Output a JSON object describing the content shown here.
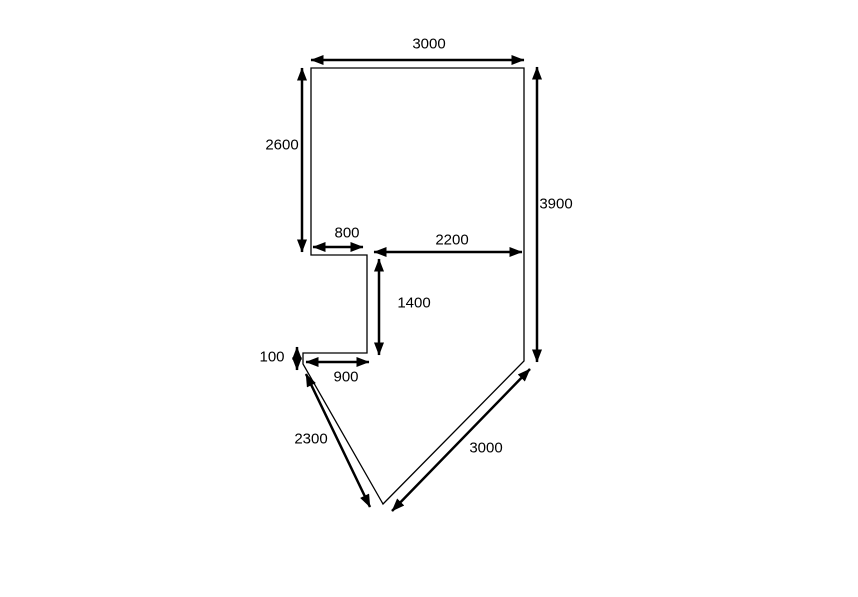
{
  "canvas": {
    "width": 858,
    "height": 597,
    "background": "#ffffff",
    "line_color": "#000000"
  },
  "style": {
    "outline_width": 1.3,
    "dimension_width": 2.5,
    "label_font_size": 15,
    "arrow_length": 13,
    "arrow_half_width": 5
  },
  "shape": {
    "name": "plan-outline",
    "points": [
      [
        311,
        68
      ],
      [
        524,
        68
      ],
      [
        524,
        361
      ],
      [
        383,
        504
      ],
      [
        303,
        364
      ],
      [
        303,
        353
      ],
      [
        367,
        353
      ],
      [
        367,
        255
      ],
      [
        311,
        255
      ]
    ]
  },
  "dimensions": [
    {
      "id": "top-width",
      "label": "3000",
      "x1": 311,
      "y1": 60,
      "x2": 524,
      "y2": 60,
      "label_x": 429,
      "label_y": 44
    },
    {
      "id": "left-height",
      "label": "2600",
      "x1": 302,
      "y1": 68,
      "x2": 302,
      "y2": 252,
      "label_x": 282,
      "label_y": 145
    },
    {
      "id": "right-height",
      "label": "3900",
      "x1": 537,
      "y1": 67,
      "x2": 537,
      "y2": 362,
      "label_x": 556,
      "label_y": 204
    },
    {
      "id": "step-width",
      "label": "800",
      "x1": 313,
      "y1": 247,
      "x2": 363,
      "y2": 247,
      "label_x": 347,
      "label_y": 233
    },
    {
      "id": "mid-width",
      "label": "2200",
      "x1": 374,
      "y1": 252,
      "x2": 522,
      "y2": 252,
      "label_x": 452,
      "label_y": 240
    },
    {
      "id": "notch-height",
      "label": "1400",
      "x1": 379,
      "y1": 259,
      "x2": 379,
      "y2": 355,
      "label_x": 414,
      "label_y": 303
    },
    {
      "id": "small-step",
      "label": "100",
      "x1": 297,
      "y1": 347,
      "x2": 297,
      "y2": 370,
      "label_x": 272,
      "label_y": 357
    },
    {
      "id": "bottom-width",
      "label": "900",
      "x1": 306,
      "y1": 362,
      "x2": 369,
      "y2": 362,
      "label_x": 346,
      "label_y": 377
    },
    {
      "id": "left-diagonal",
      "label": "2300",
      "x1": 306,
      "y1": 374,
      "x2": 370,
      "y2": 507,
      "label_x": 311,
      "label_y": 439
    },
    {
      "id": "right-diagonal",
      "label": "3000",
      "x1": 530,
      "y1": 369,
      "x2": 392,
      "y2": 511,
      "label_x": 486,
      "label_y": 448
    }
  ]
}
